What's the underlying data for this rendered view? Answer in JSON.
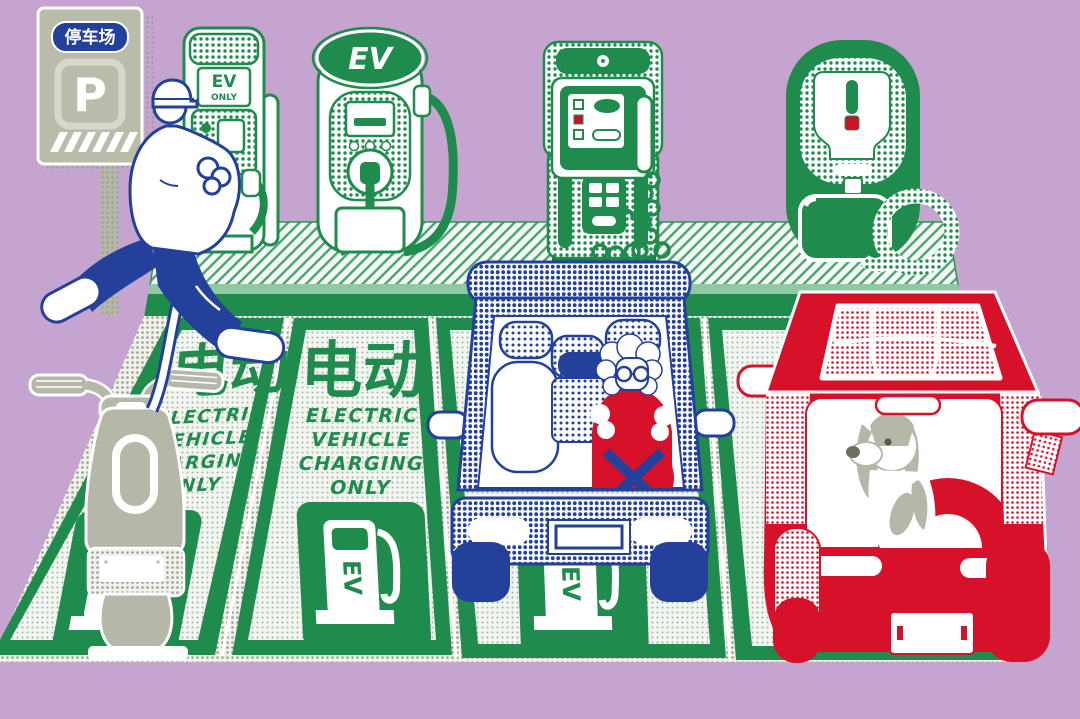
{
  "parking_sign": {
    "badge_text": "停车场",
    "symbol": "P"
  },
  "chargers": {
    "station1": {
      "label_line1": "EV",
      "label_line2": "ONLY"
    },
    "station2": {
      "label": "EV"
    }
  },
  "spot_marking": {
    "chinese_text": "电动",
    "english_line1": "ELECTRIC",
    "english_line2": "VEHICLE",
    "english_line3": "CHARGING",
    "english_line4": "ONLY",
    "pump_icon_label": "EV"
  },
  "colors": {
    "background": "#c5a4cf",
    "green": "#1f8b4d",
    "light_green": "#8ec9a4",
    "blue": "#23409a",
    "red": "#d8112b",
    "gray": "#b5b8a8",
    "white": "#ffffff"
  }
}
